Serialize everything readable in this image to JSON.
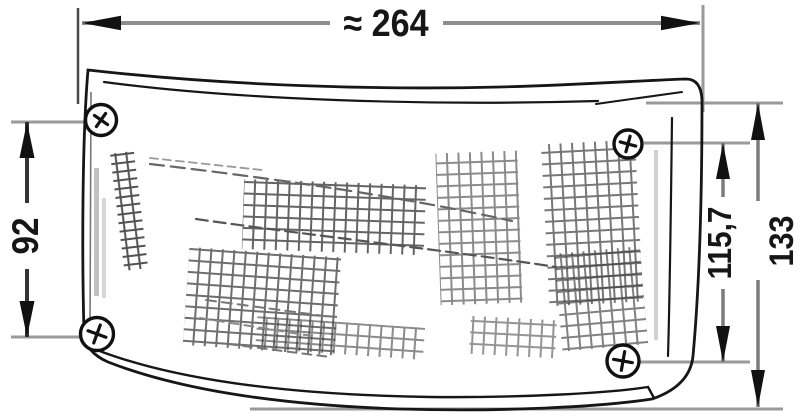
{
  "title": "Lamp technical drawing",
  "dimensions": {
    "width": {
      "label": "≈ 264"
    },
    "left_height": {
      "label": "92"
    },
    "right_inner_height": {
      "label": "115,7"
    },
    "right_outer_height": {
      "label": "133"
    }
  },
  "colors": {
    "background": "#ffffff",
    "outline": "#161616",
    "dimension_line": "#8e8e8e",
    "extension_line": "#9a9a9a",
    "arrow": "#111111"
  },
  "icons": {
    "fastener": "phillips-screw"
  }
}
